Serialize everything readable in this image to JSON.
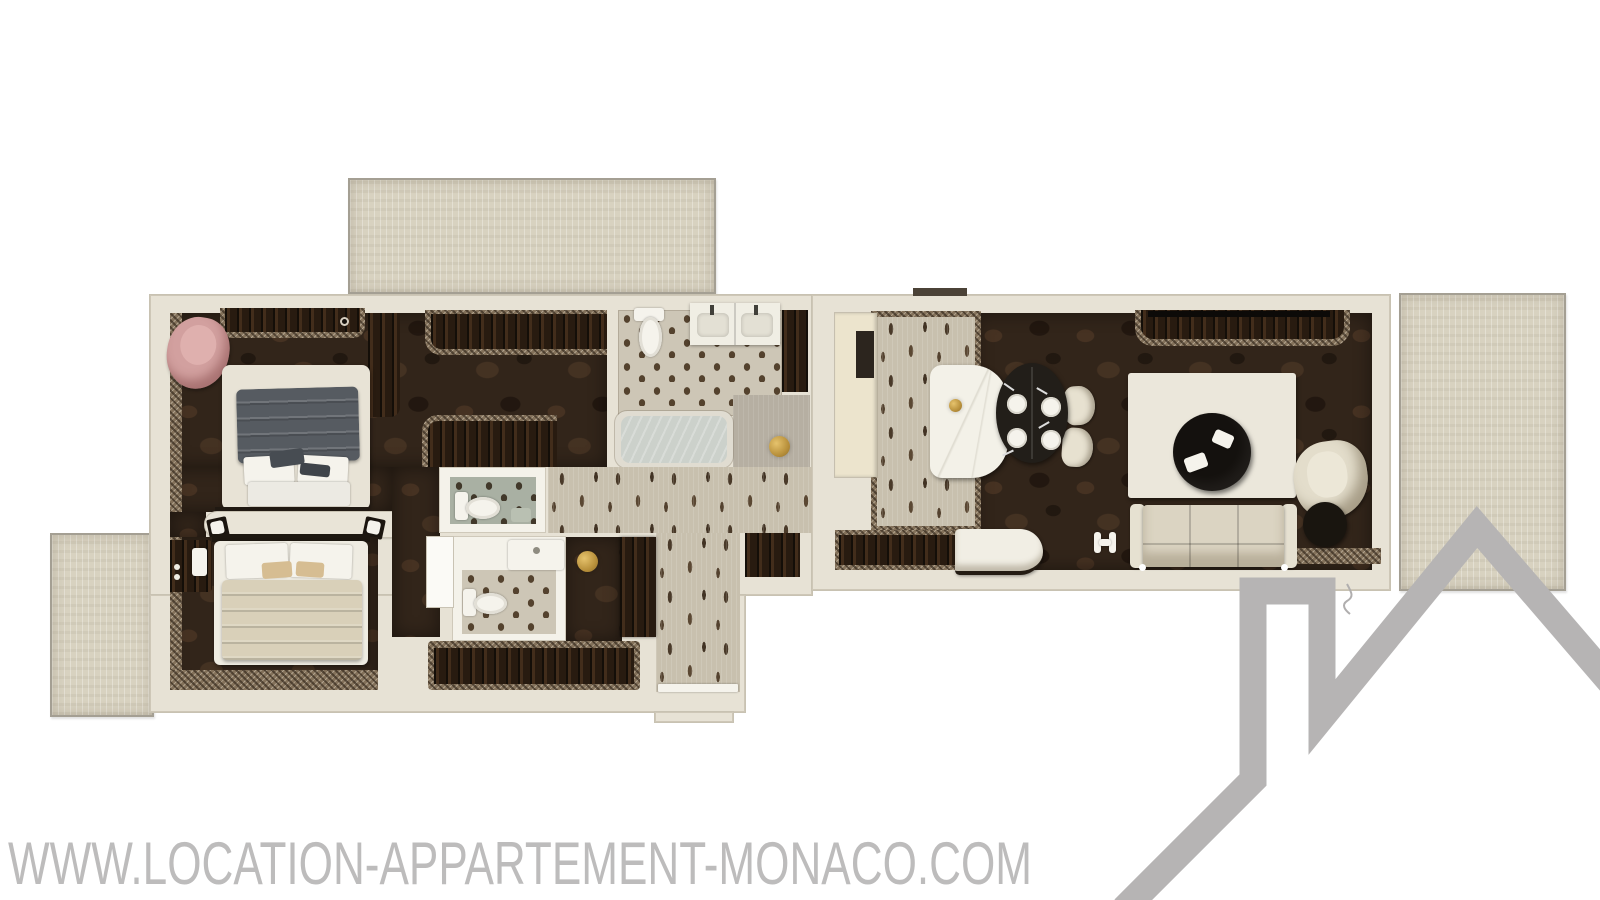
{
  "watermark": {
    "text": "WWW.LOCATION-APPARTEMENT-MONACO.COM",
    "color": "#bdbcbc"
  },
  "logo": {
    "name": "house-roofline-logo",
    "color": "#b6b4b4"
  },
  "palette": {
    "background": "#ffffff",
    "wall": "#e7e2d5",
    "terrace_floor": "#d8d2c0",
    "dark_wood_floor": "#32251a",
    "hall_carpet": "#c8c0ae",
    "bath_tile": "#cdc6b6",
    "wc_tile_green": "#a9b0a3",
    "gold_accent": "#c9a54e",
    "cream_furniture": "#e8e3d6",
    "charcoal_furniture": "#16110e",
    "pink_chair": "#d2a09f",
    "duvet_gray": "#565b61",
    "duvet_beige": "#d9d0b9"
  }
}
